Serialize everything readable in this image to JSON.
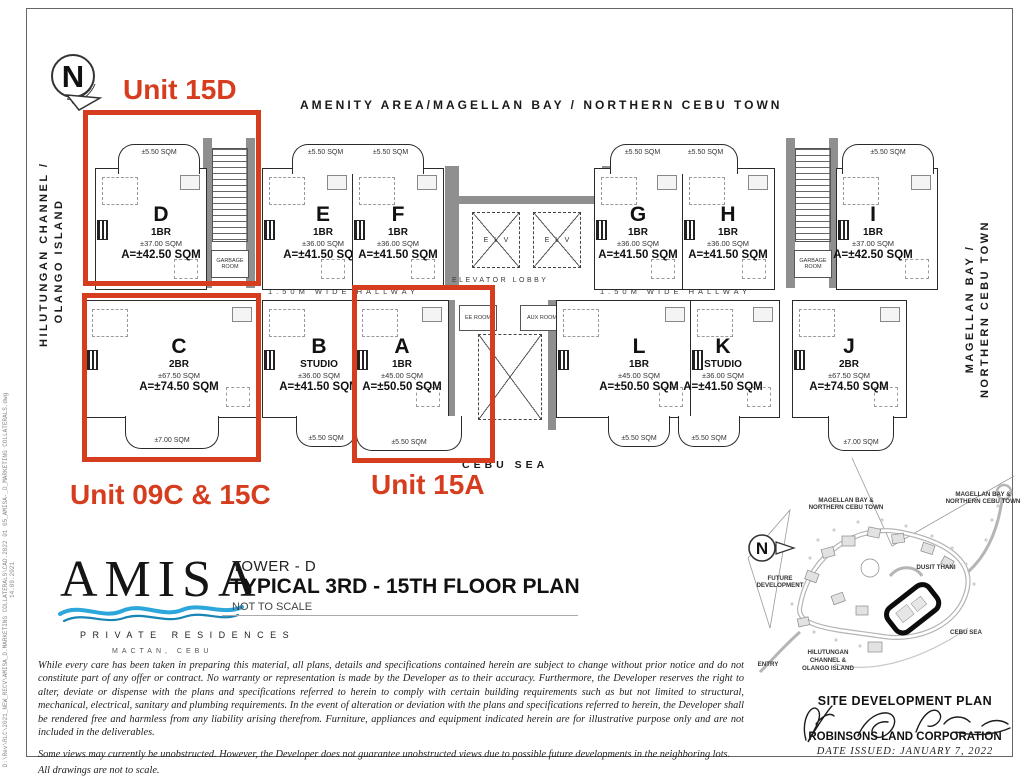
{
  "colors": {
    "annotation_red": "#d63c1e",
    "wave_blue": "#2ba7dc",
    "wall_gray": "#8f8f8f"
  },
  "annotations": {
    "unit_15d": "Unit 15D",
    "unit_09c_15c": "Unit 09C & 15C",
    "unit_15a": "Unit 15A"
  },
  "headers": {
    "amenity": "AMENITY AREA/MAGELLAN BAY / NORTHERN CEBU TOWN",
    "left_vertical": [
      "HILUTUNGAN CHANNEL /",
      "OLANGO ISLAND"
    ],
    "right_vertical": [
      "MAGELLAN BAY /",
      "NORTHERN CEBU TOWN"
    ]
  },
  "plan": {
    "hallway_label": "1.50M WIDE HALLWAY",
    "elevator_lobby": "ELEVATOR LOBBY",
    "elv": "ELV",
    "garbage_room": "GARBAGE ROOM",
    "ee_room": "EE ROOM",
    "aux_room": "AUX ROOM",
    "cebu_sea": "CEBU SEA",
    "balcony_labels": {
      "small": "±5.50 SQM",
      "large": "±7.00 SQM"
    },
    "units": [
      {
        "letter": "D",
        "type": "1BR",
        "size": "±37.00 SQM",
        "area": "A=±42.50 SQM"
      },
      {
        "letter": "E",
        "type": "1BR",
        "size": "±36.00 SQM",
        "area": "A=±41.50 SQM"
      },
      {
        "letter": "F",
        "type": "1BR",
        "size": "±36.00 SQM",
        "area": "A=±41.50 SQM"
      },
      {
        "letter": "G",
        "type": "1BR",
        "size": "±36.00 SQM",
        "area": "A=±41.50 SQM"
      },
      {
        "letter": "H",
        "type": "1BR",
        "size": "±36.00 SQM",
        "area": "A=±41.50 SQM"
      },
      {
        "letter": "I",
        "type": "1BR",
        "size": "±37.00 SQM",
        "area": "A=±42.50 SQM"
      },
      {
        "letter": "C",
        "type": "2BR",
        "size": "±67.50 SQM",
        "area": "A=±74.50 SQM"
      },
      {
        "letter": "B",
        "type": "STUDIO",
        "size": "±36.00 SQM",
        "area": "A=±41.50 SQM"
      },
      {
        "letter": "A",
        "type": "1BR",
        "size": "±45.00 SQM",
        "area": "A=±50.50 SQM"
      },
      {
        "letter": "L",
        "type": "1BR",
        "size": "±45.00 SQM",
        "area": "A=±50.50 SQM"
      },
      {
        "letter": "K",
        "type": "STUDIO",
        "size": "±36.00 SQM",
        "area": "A=±41.50 SQM"
      },
      {
        "letter": "J",
        "type": "2BR",
        "size": "±67.50 SQM",
        "area": "A=±74.50 SQM"
      }
    ]
  },
  "logo": {
    "name": "AMISA",
    "subtitle": "PRIVATE RESIDENCES",
    "city": "MACTAN, CEBU"
  },
  "title_block": {
    "tower": "TOWER - D",
    "title": "TYPICAL 3RD - 15TH FLOOR PLAN",
    "scale": "NOT TO SCALE"
  },
  "disclaimer": {
    "p1": "While every care has been taken in preparing this material, all plans, details and specifications contained herein are subject to change without prior notice and do not constitute part of any offer or contract. No warranty or representation is made by the Developer as to their accuracy.  Furthermore, the Developer reserves the right to alter, deviate or dispense with the plans and specifications referred to herein to comply with certain building requirements such as but not limited to structural, mechanical, electrical, sanitary and plumbing requirements. In the event of alteration or deviation with the plans and specifications referred to herein, the Developer shall be rendered free and harmless from any liability arising therefrom. Furniture, appliances and equipment indicated herein are for illustrative purpose only and are not included in the deliverables.",
    "p2": "Some views may currently be unobstructed. However, the Developer does not guarantee unobstructed views due to possible future developments in the neighboring lots.",
    "p3": "All drawings are not to scale."
  },
  "site_plan": {
    "label_bay_left": [
      "MAGELLAN BAY &",
      "NORTHERN CEBU TOWN"
    ],
    "label_bay_right": [
      "MAGELLAN BAY &",
      "NORTHERN CEBU TOWN"
    ],
    "dusit": "DUSIT THANI",
    "future": [
      "FUTURE",
      "DEVELOPMENT"
    ],
    "entry": "ENTRY",
    "cebu_sea": "CEBU SEA",
    "hilutungan": [
      "HILUTUNGAN",
      "CHANNEL &",
      "OLANGO ISLAND"
    ],
    "title": "SITE DEVELOPMENT PLAN",
    "company": "ROBINSONS LAND CORPORATION",
    "date_issued": "DATE ISSUED:  JANUARY 7, 2022"
  },
  "side_note": "D:\\Rev\\RLC\\2021_NEW_RECV\\AMISA_D.MARKETING COLLATERALS\\CAD.2022 01 05_AMISA-_D_MARKETING COLLATERALS.dwg   14.09.2021"
}
